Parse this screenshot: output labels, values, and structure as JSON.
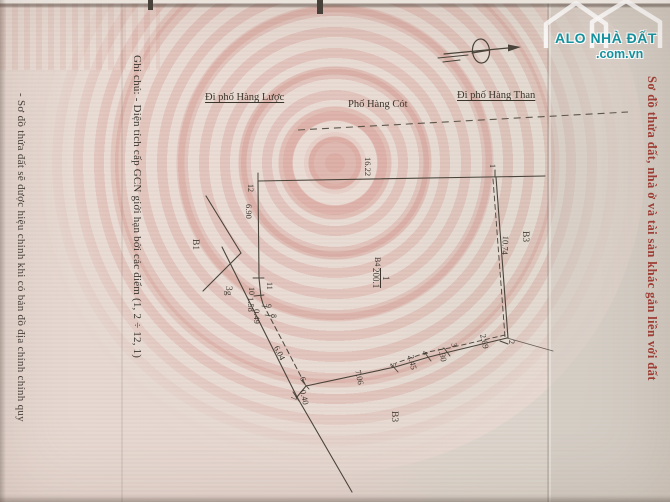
{
  "brand": {
    "name": "ALO NHÀ ĐẤT",
    "domain": ".com.vn",
    "color": "#1293a0"
  },
  "titles": {
    "right_red": "Sơ đồ thửa đất, nhà ở và tài sản khác gắn liền với đất"
  },
  "notes": {
    "left": "- Sơ đồ thửa đất sẽ được hiệu chỉnh khi có bản đồ địa chính chính quy",
    "ghi_chu": "Ghi chú: - Diện tích cấp GCN giới hạn bởi các điểm (1, 2 ÷ 12, 1)"
  },
  "streets": {
    "to_hang_luoc": "Đi phố Hàng Lược",
    "hang_cot": "Phố Hàng Cót",
    "to_hang_than": "Đi phố Hàng Than"
  },
  "parcel": {
    "block": "B4",
    "lot": "1",
    "area": "200.1"
  },
  "plot": {
    "edge_labels": [
      {
        "text": "16.22",
        "x": 373,
        "y": 157,
        "rot": 90,
        "cls": "dim"
      },
      {
        "text": "6.90",
        "x": 254,
        "y": 204,
        "rot": 90,
        "cls": "dim"
      },
      {
        "text": "10.74",
        "x": 511,
        "y": 236,
        "rot": 93,
        "cls": "dim"
      },
      {
        "text": "2.69",
        "x": 488,
        "y": 333,
        "rot": 78,
        "cls": "dim"
      },
      {
        "text": "1.30",
        "x": 446,
        "y": 346,
        "rot": 78,
        "cls": "dim"
      },
      {
        "text": "2.45",
        "x": 416,
        "y": 354,
        "rot": 78,
        "cls": "dim"
      },
      {
        "text": "7.06",
        "x": 363,
        "y": 369,
        "rot": 78,
        "cls": "dim"
      },
      {
        "text": "0.40",
        "x": 308,
        "y": 389,
        "rot": 78,
        "cls": "dim"
      },
      {
        "text": "6.04",
        "x": 281,
        "y": 344,
        "rot": 64,
        "cls": "dim"
      },
      {
        "text": "0.49",
        "x": 262,
        "y": 309,
        "rot": 90,
        "cls": "dim"
      },
      {
        "text": "1.58",
        "x": 256,
        "y": 297,
        "rot": 90,
        "cls": "dim"
      },
      {
        "text": "12",
        "x": 255,
        "y": 184,
        "rot": 90,
        "cls": "pt"
      },
      {
        "text": "11",
        "x": 274,
        "y": 282,
        "rot": 90,
        "cls": "pt"
      },
      {
        "text": "10",
        "x": 256,
        "y": 287,
        "rot": 90,
        "cls": "pt"
      },
      {
        "text": "9",
        "x": 273,
        "y": 304,
        "rot": 90,
        "cls": "pt"
      },
      {
        "text": "8",
        "x": 278,
        "y": 314,
        "rot": 90,
        "cls": "pt"
      },
      {
        "text": "7",
        "x": 298,
        "y": 396,
        "rot": 90,
        "cls": "pt"
      },
      {
        "text": "6",
        "x": 307,
        "y": 376,
        "rot": 78,
        "cls": "pt"
      },
      {
        "text": "5",
        "x": 397,
        "y": 362,
        "rot": 78,
        "cls": "pt"
      },
      {
        "text": "4",
        "x": 429,
        "y": 350,
        "rot": 78,
        "cls": "pt"
      },
      {
        "text": "3",
        "x": 458,
        "y": 342,
        "rot": 78,
        "cls": "pt"
      },
      {
        "text": "2",
        "x": 516,
        "y": 340,
        "rot": 90,
        "cls": "pt"
      },
      {
        "text": "1",
        "x": 497,
        "y": 164,
        "rot": 90,
        "cls": "pt"
      },
      {
        "text": "B1",
        "x": 200,
        "y": 239,
        "rot": 90,
        "cls": "blk"
      },
      {
        "text": "B3",
        "x": 530,
        "y": 231,
        "rot": 90,
        "cls": "blk"
      },
      {
        "text": "B3",
        "x": 399,
        "y": 411,
        "rot": 90,
        "cls": "blk"
      },
      {
        "text": "3g",
        "x": 233,
        "y": 286,
        "rot": 90,
        "cls": "blk"
      }
    ]
  }
}
